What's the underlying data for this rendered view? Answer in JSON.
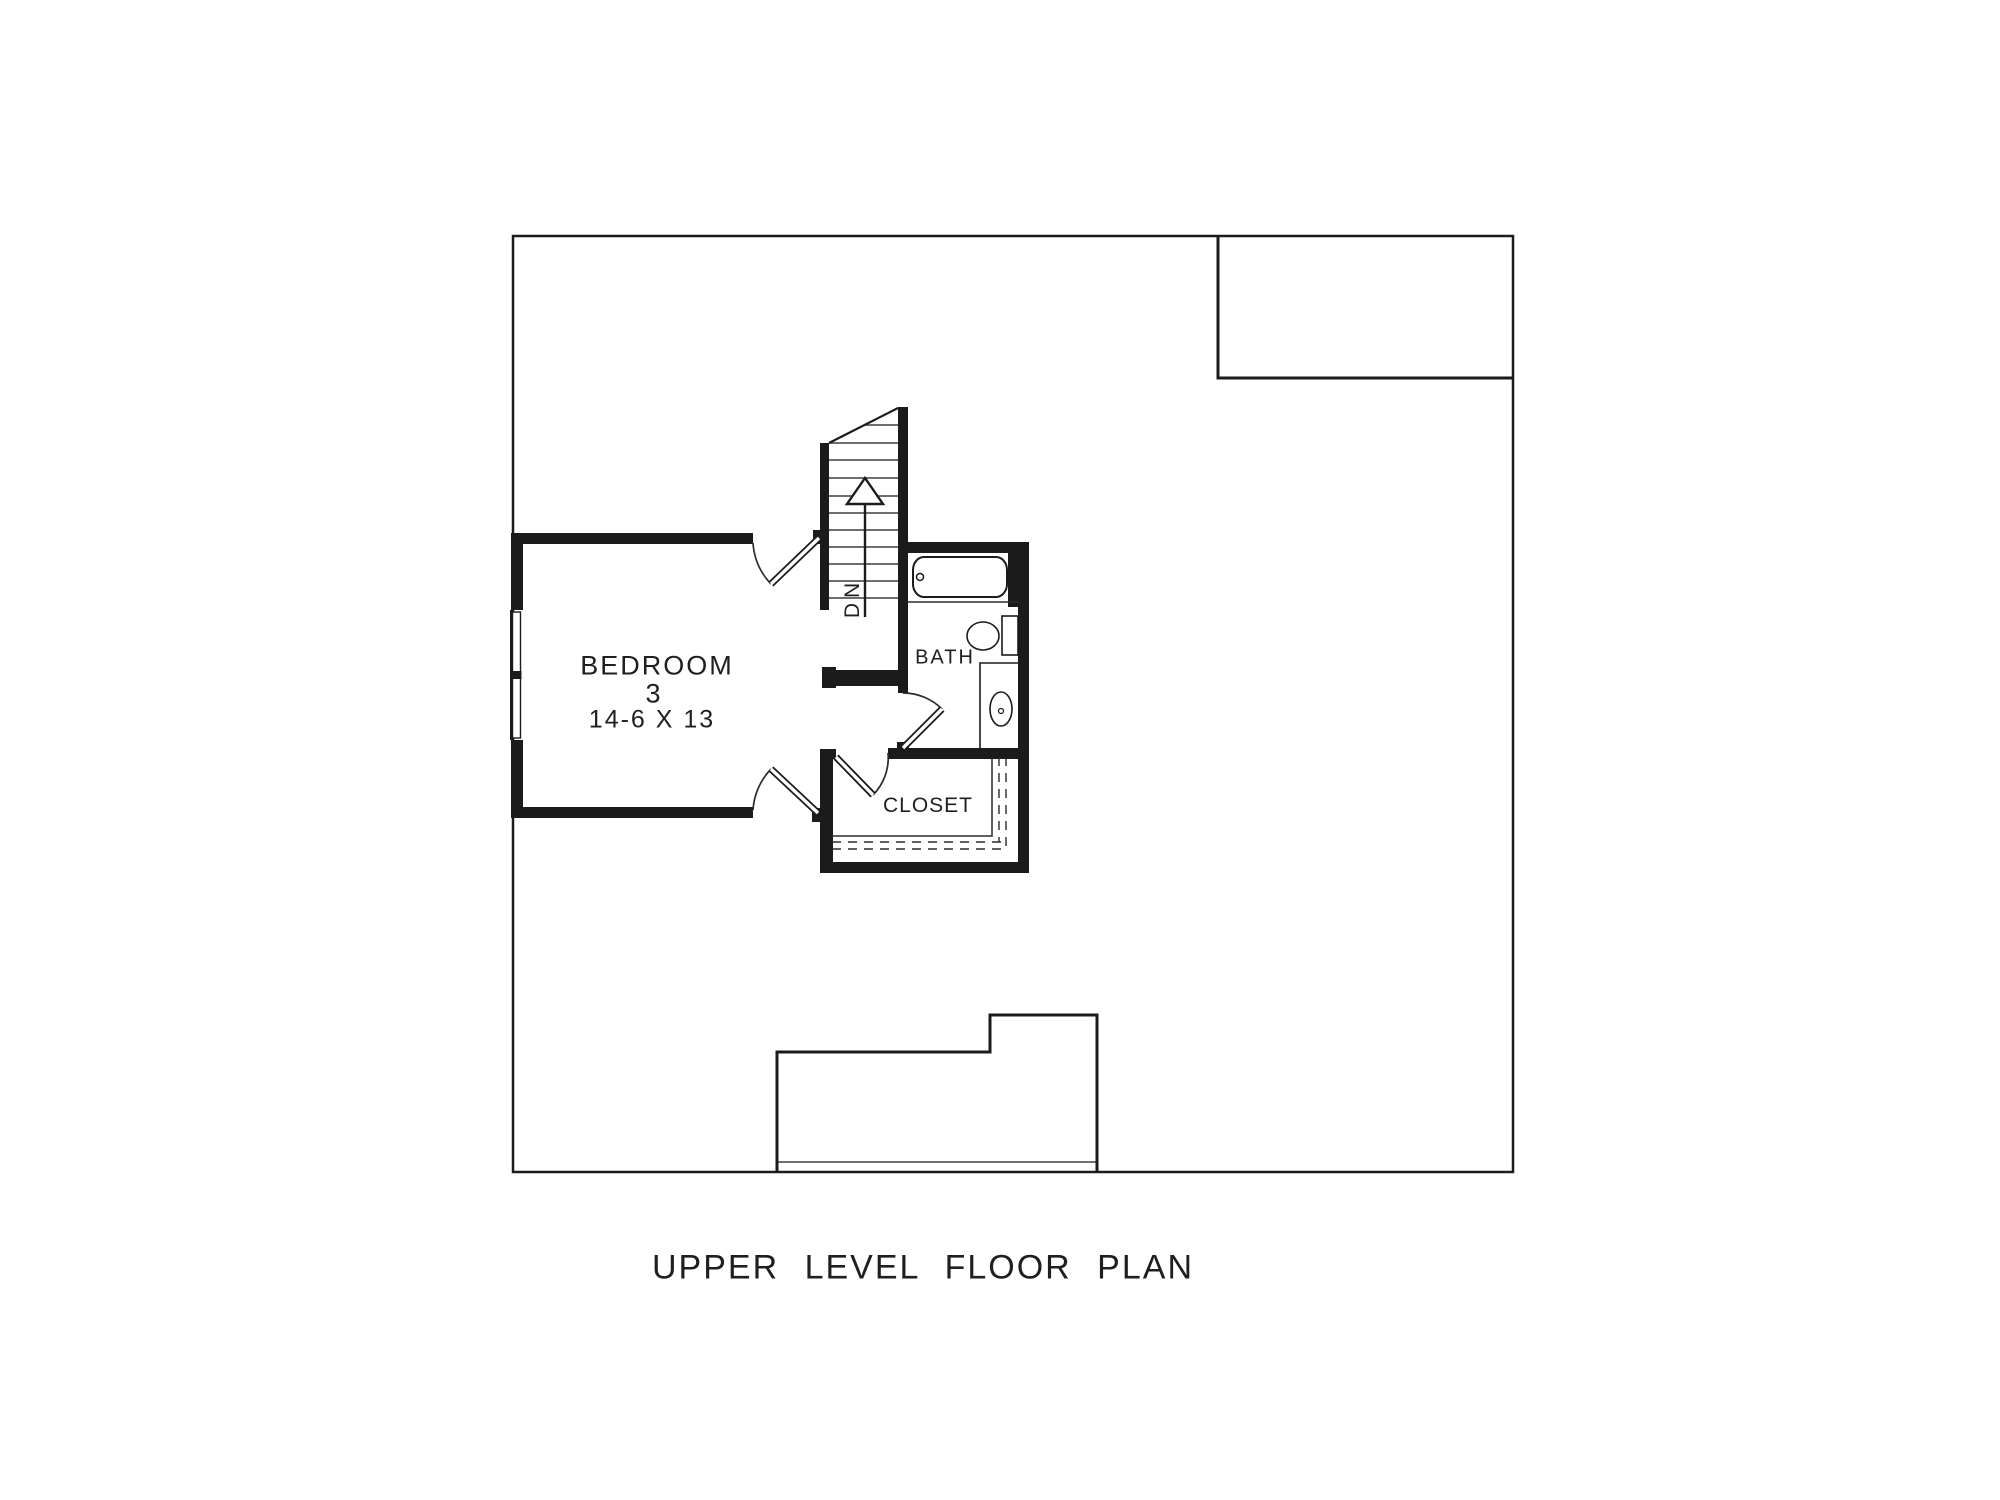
{
  "title": "UPPER LEVEL FLOOR PLAN",
  "rooms": {
    "bedroom": {
      "name": "BEDROOM",
      "number": "3",
      "dimensions": "14-6 X 13"
    },
    "bath": {
      "name": "BATH"
    },
    "closet": {
      "name": "CLOSET"
    }
  },
  "stairs": {
    "down_label": "DN"
  },
  "fixtures": {
    "bathtub": "bathtub-icon",
    "toilet": "toilet-icon",
    "vanity_sink": "vanity-sink-icon",
    "closet_shelf": "closet-shelf-icon",
    "window": "window-icon",
    "stair_down_arrow": "stair-arrow-icon"
  },
  "colors": {
    "ink": "#1b1b1b",
    "background": "#ffffff"
  }
}
